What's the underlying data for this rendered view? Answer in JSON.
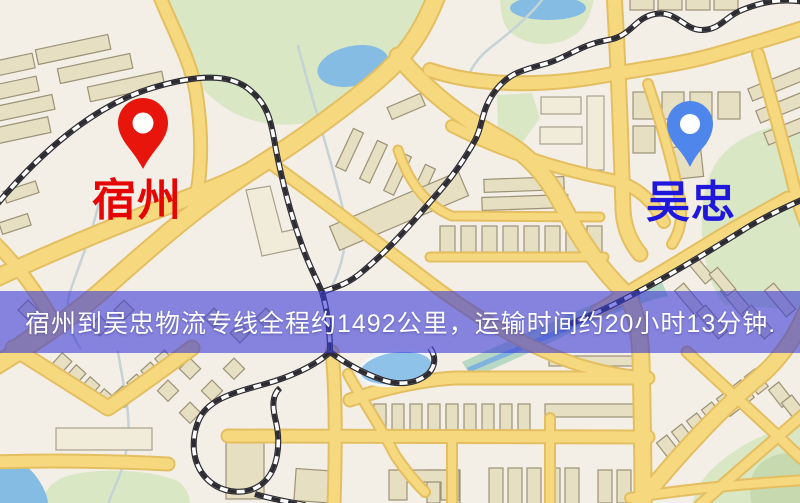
{
  "banner": {
    "text": "宿州到吴忠物流专线全程约1492公里，运输时间约20小时13分钟.",
    "distance_text": "约1492公里",
    "duration_text": "约20小时13分钟"
  },
  "origin": {
    "name": "宿州",
    "pin_color": "#e8150d",
    "label_color": "#e60505"
  },
  "destination": {
    "name": "吴忠",
    "pin_color": "#4f86ec",
    "label_color": "#2017dd"
  },
  "map_colors": {
    "background": "#f4efe6",
    "road_fill": "#f6d87e",
    "road_casing": "#e4bf62",
    "park": "#d9e7c4",
    "water": "#85bce4",
    "building": "#e7dfc2",
    "railway": "#2b2b31"
  }
}
